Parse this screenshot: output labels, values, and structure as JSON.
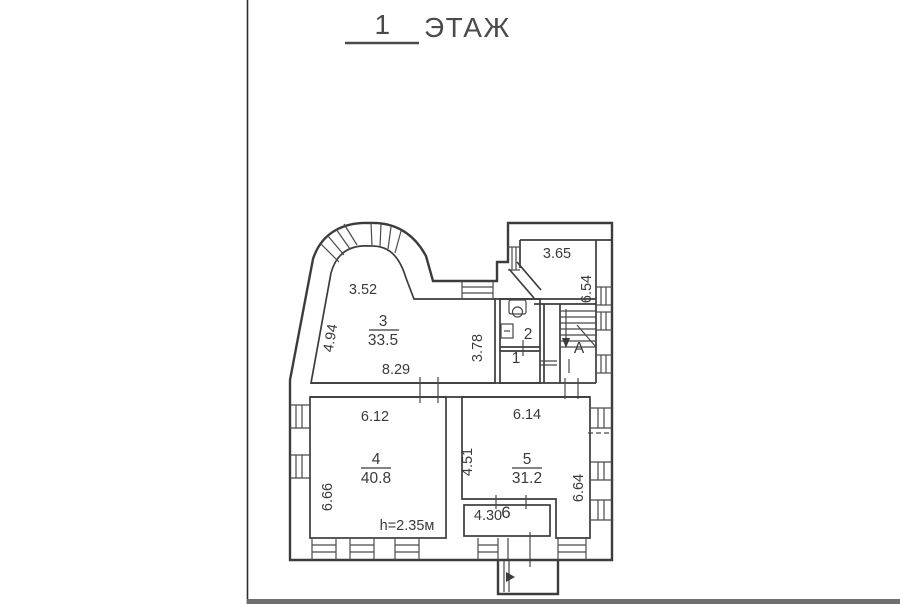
{
  "title": {
    "number": "1",
    "word": "ЭТАЖ"
  },
  "rooms": {
    "r1": {
      "number": "1"
    },
    "r2": {
      "number": "2"
    },
    "r3": {
      "number": "3",
      "area": "33.5"
    },
    "r4": {
      "number": "4",
      "area": "40.8"
    },
    "r5": {
      "number": "5",
      "area": "31.2"
    },
    "r6": {
      "number": "6"
    },
    "stair": {
      "letter": "А"
    }
  },
  "dimensions": {
    "room3_top": "3.52",
    "room3_left": "4.94",
    "room3_bottom": "8.29",
    "room3_right": "3.78",
    "hall_top": "3.65",
    "hall_right": "6.54",
    "room4_top": "6.12",
    "room4_left": "6.66",
    "ceiling_height": "h=2.35м",
    "room5_top": "6.14",
    "room5_left": "4.51",
    "room5_right": "6.64",
    "room6_width": "4.30"
  },
  "colors": {
    "ink": "#3c3c3c",
    "scan_edge": "#2e2e2e",
    "bottom_bar": "#6f6f6f"
  }
}
